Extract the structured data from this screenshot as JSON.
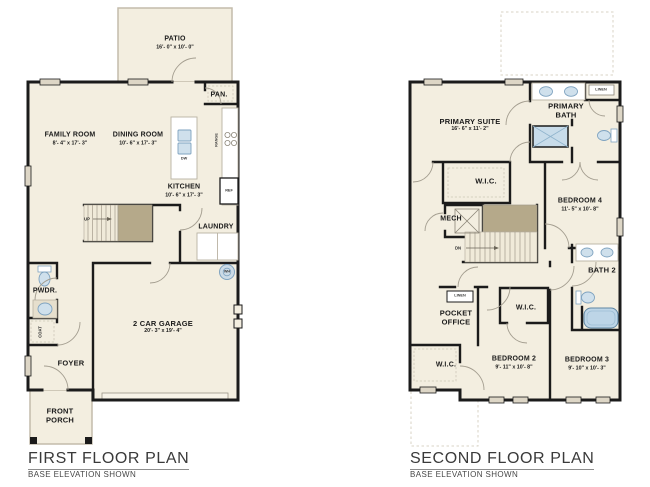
{
  "first_floor": {
    "title": "FIRST FLOOR PLAN",
    "subtitle": "BASE ELEVATION SHOWN",
    "patio": {
      "name": "PATIO",
      "dims": "16'- 0\" x 10'- 0\""
    },
    "pantry": {
      "name": "PAN."
    },
    "family_room": {
      "name": "FAMILY ROOM",
      "dims": "8'- 4\" x 17'- 3\""
    },
    "dining_room": {
      "name": "DINING ROOM",
      "dims": "10'- 6\" x 17'- 3\""
    },
    "kitchen": {
      "name": "KITCHEN",
      "dims": "10'- 6\" x 17'- 3\""
    },
    "laundry": {
      "name": "LAUNDRY"
    },
    "powder": {
      "name": "PWDR."
    },
    "coat": {
      "name": "COAT"
    },
    "garage": {
      "name": "2 CAR GARAGE",
      "dims": "20'- 3\" x 19'- 4\""
    },
    "foyer": {
      "name": "FOYER"
    },
    "front_porch": {
      "name": "FRONT PORCH"
    },
    "up_label": "UP",
    "dw_label": "DW",
    "range_label": "RANGE",
    "ref_label": "REF",
    "wh_label": "WH"
  },
  "second_floor": {
    "title": "SECOND FLOOR PLAN",
    "subtitle": "BASE ELEVATION SHOWN",
    "primary_suite": {
      "name": "PRIMARY SUITE",
      "dims": "16'- 6\" x 11'- 2\""
    },
    "primary_bath": {
      "name": "PRIMARY BATH"
    },
    "linen_bath": {
      "name": "LINEN"
    },
    "wic_primary": {
      "name": "W.I.C."
    },
    "mech": {
      "name": "MECH"
    },
    "bedroom4": {
      "name": "BEDROOM 4",
      "dims": "11'- 5\" x 10'- 8\""
    },
    "dn_label": "DN",
    "bath2": {
      "name": "BATH 2"
    },
    "linen_hall": {
      "name": "LINEN"
    },
    "pocket_office": {
      "name": "POCKET OFFICE"
    },
    "wic_bedroom2": {
      "name": "W.I.C."
    },
    "wic_left": {
      "name": "W.I.C."
    },
    "bedroom2": {
      "name": "BEDROOM 2",
      "dims": "9'- 11\" x 10'- 8\""
    },
    "bedroom3": {
      "name": "BEDROOM 3",
      "dims": "9'- 10\" x 10'- 3\""
    }
  },
  "colors": {
    "floor": "#f3eee0",
    "wall": "#1b1b1b",
    "fixture_blue": "#cfe0ec",
    "stair_brown": "#b5a98a",
    "window_gray": "#ddd6c6"
  }
}
